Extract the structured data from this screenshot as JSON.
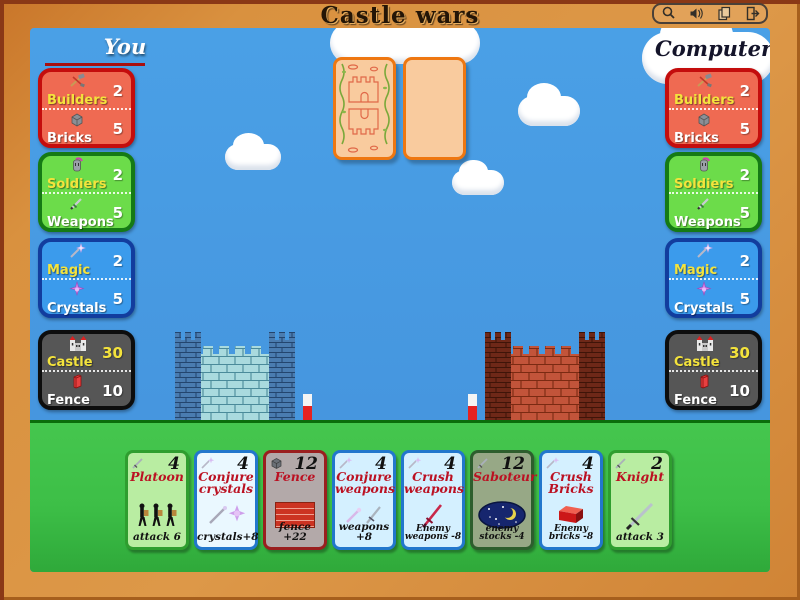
{
  "title": "Castle wars",
  "toolbar": {
    "icons": [
      "magnifier-icon",
      "sound-icon",
      "cards-icon",
      "exit-icon"
    ]
  },
  "players": {
    "you": {
      "label": "You"
    },
    "computer": {
      "label": "Computer"
    }
  },
  "resources": {
    "you": {
      "builders_panel": {
        "row1": {
          "label": "Builders",
          "value": "2"
        },
        "row2": {
          "label": "Bricks",
          "value": "5"
        }
      },
      "soldiers_panel": {
        "row1": {
          "label": "Soldiers",
          "value": "2"
        },
        "row2": {
          "label": "Weapons",
          "value": "5"
        }
      },
      "magic_panel": {
        "row1": {
          "label": "Magic",
          "value": "2"
        },
        "row2": {
          "label": "Crystals",
          "value": "5"
        }
      },
      "castle_panel": {
        "row1": {
          "label": "Castle",
          "value": "30"
        },
        "row2": {
          "label": "Fence",
          "value": "10"
        }
      }
    },
    "computer": {
      "builders_panel": {
        "row1": {
          "label": "Builders",
          "value": "2"
        },
        "row2": {
          "label": "Bricks",
          "value": "5"
        }
      },
      "soldiers_panel": {
        "row1": {
          "label": "Soldiers",
          "value": "2"
        },
        "row2": {
          "label": "Weapons",
          "value": "5"
        }
      },
      "magic_panel": {
        "row1": {
          "label": "Magic",
          "value": "2"
        },
        "row2": {
          "label": "Crystals",
          "value": "5"
        }
      },
      "castle_panel": {
        "row1": {
          "label": "Castle",
          "value": "30"
        },
        "row2": {
          "label": "Fence",
          "value": "10"
        }
      }
    }
  },
  "hand": [
    {
      "name": "Platoon",
      "cost": "4",
      "effect": "attack 6",
      "cost_icon": "sword-icon",
      "art": "soldiers-art",
      "theme_color": "#2f9e2f"
    },
    {
      "name": "Conjure crystals",
      "cost": "4",
      "effect": "crystals+8",
      "cost_icon": "wand-icon",
      "art": "wand-crystal-art",
      "theme_color": "#2277cc"
    },
    {
      "name": "Fence",
      "cost": "12",
      "effect": "fence +22",
      "cost_icon": "brick-icon",
      "art": "brick-wall-art",
      "theme_color": "#9a1f1f"
    },
    {
      "name": "Conjure weapons",
      "cost": "4",
      "effect": "weapons +8",
      "cost_icon": "wand-icon",
      "art": "wand-sword-art",
      "theme_color": "#2277cc"
    },
    {
      "name": "Crush weapons",
      "cost": "4",
      "effect": "Enemy weapons -8",
      "cost_icon": "wand-icon",
      "art": "red-sword-art",
      "theme_color": "#2277cc"
    },
    {
      "name": "Saboteur",
      "cost": "12",
      "effect": "enemy stocks -4",
      "cost_icon": "sword-icon",
      "art": "night-art",
      "theme_color": "#2d5e2d"
    },
    {
      "name": "Crush Bricks",
      "cost": "4",
      "effect": "Enemy bricks -8",
      "cost_icon": "wand-icon",
      "art": "red-brick-art",
      "theme_color": "#2277cc"
    },
    {
      "name": "Knight",
      "cost": "2",
      "effect": "attack 3",
      "cost_icon": "sword-icon",
      "art": "sword-art",
      "theme_color": "#2f9e2f"
    }
  ],
  "colors": {
    "frame": "#d9913f",
    "sky": "#4a9ce2",
    "grass": "#3dbf47",
    "left_castle": "#a9dade",
    "right_castle": "#c2543a",
    "card_back_border": "#ee7711",
    "title_text": "#241506"
  }
}
